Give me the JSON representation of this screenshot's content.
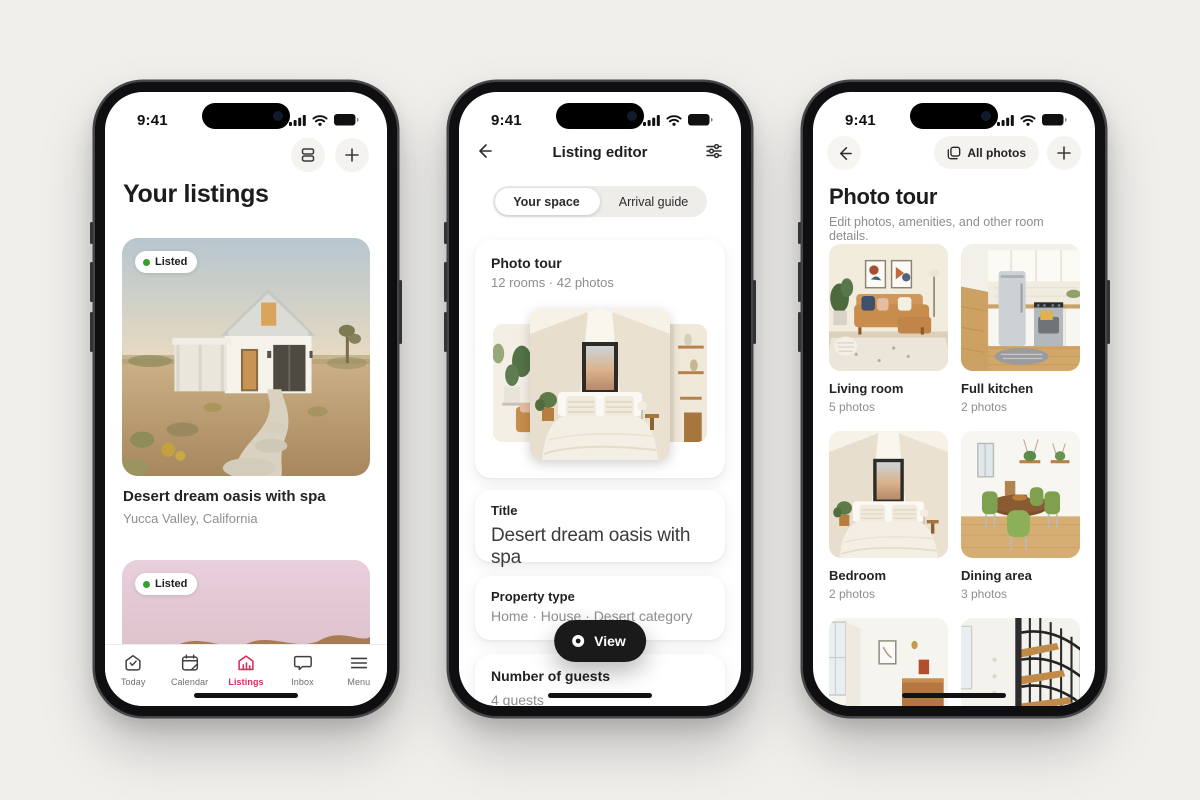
{
  "status": {
    "time": "9:41"
  },
  "colors": {
    "accent": "#df2a57",
    "listed_dot": "#34a02e",
    "page_bg": "#f0efec"
  },
  "listings_screen": {
    "title": "Your listings",
    "badge": "Listed",
    "listing1": {
      "title": "Desert dream oasis with spa",
      "location": "Yucca Valley, California"
    },
    "tabs": {
      "today": "Today",
      "calendar": "Calendar",
      "listings": "Listings",
      "inbox": "Inbox",
      "menu": "Menu"
    }
  },
  "editor_screen": {
    "title": "Listing editor",
    "segment_your_space": "Your space",
    "segment_arrival_guide": "Arrival guide",
    "photo_tour": {
      "title": "Photo tour",
      "meta": "12 rooms · 42 photos"
    },
    "title_card": {
      "label": "Title",
      "value": "Desert dream oasis with spa"
    },
    "property_card": {
      "label": "Property type",
      "value": "Home · House · Desert category"
    },
    "guests_card": {
      "label": "Number of guests",
      "value": "4 guests"
    },
    "view_button_label": "View"
  },
  "photo_tour_screen": {
    "all_photos_label": "All photos",
    "title": "Photo tour",
    "subtitle": "Edit photos, amenities, and other room details.",
    "rooms": [
      {
        "name": "Living room",
        "count": "5 photos"
      },
      {
        "name": "Full kitchen",
        "count": "2 photos"
      },
      {
        "name": "Bedroom",
        "count": "2 photos"
      },
      {
        "name": "Dining area",
        "count": "3 photos"
      }
    ]
  }
}
